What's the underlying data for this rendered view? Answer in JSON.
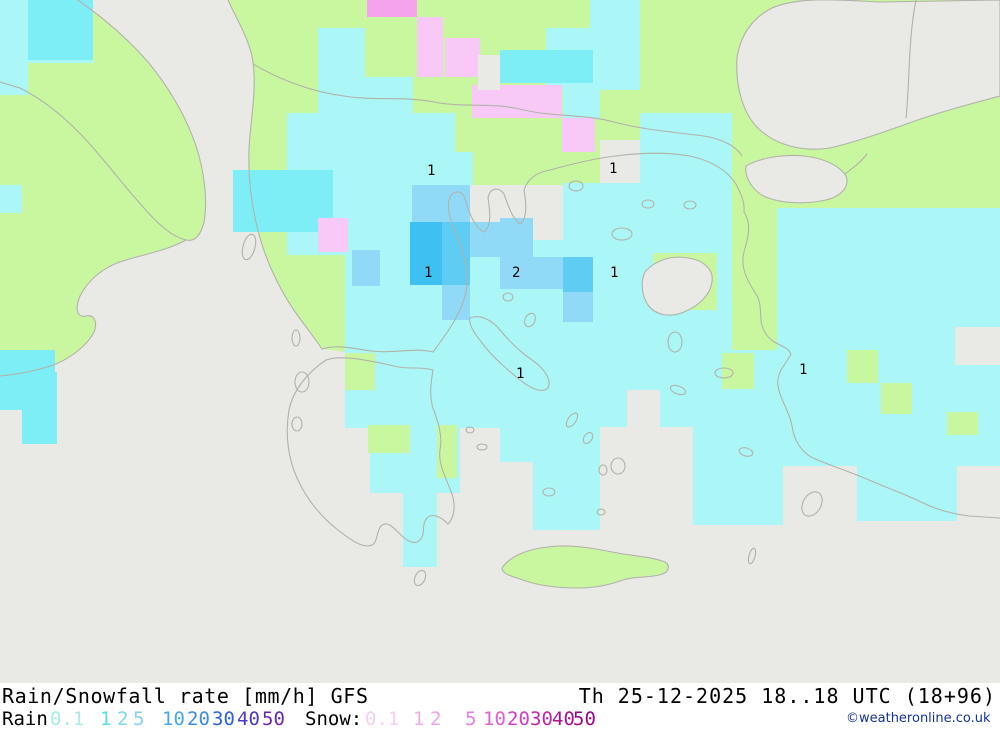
{
  "header": {
    "title_left": "Rain/Snowfall rate [mm/h] GFS",
    "title_right": "Th 25-12-2025 18..18 UTC (18+96)",
    "copyright": "©weatheronline.co.uk"
  },
  "legend": {
    "rain_label": "Rain",
    "rain_label_x": 2,
    "snow_label": "Snow:",
    "snow_label_x": 305,
    "rain_scale": [
      {
        "v": "0.1",
        "x": 50,
        "c": "#a9ebe7"
      },
      {
        "v": "1",
        "x": 100,
        "c": "#55dfe2"
      },
      {
        "v": "2",
        "x": 117,
        "c": "#7fd7f2"
      },
      {
        "v": "5",
        "x": 133,
        "c": "#86cef2"
      },
      {
        "v": "10",
        "x": 162,
        "c": "#47a8f0"
      },
      {
        "v": "20",
        "x": 187,
        "c": "#3b8bea"
      },
      {
        "v": "30",
        "x": 212,
        "c": "#2c63dd"
      },
      {
        "v": "40",
        "x": 237,
        "c": "#4a3ac9"
      },
      {
        "v": "50",
        "x": 262,
        "c": "#6b27b3"
      }
    ],
    "snow_scale": [
      {
        "v": "0.1",
        "x": 365,
        "c": "#f2d2ee"
      },
      {
        "v": "1",
        "x": 413,
        "c": "#efb0e9"
      },
      {
        "v": "2",
        "x": 430,
        "c": "#eda4e7"
      },
      {
        "v": "5",
        "x": 465,
        "c": "#e77edf"
      },
      {
        "v": "10",
        "x": 483,
        "c": "#e05fd3"
      },
      {
        "v": "20",
        "x": 507,
        "c": "#d33fc2"
      },
      {
        "v": "30",
        "x": 530,
        "c": "#c125aa"
      },
      {
        "v": "40",
        "x": 552,
        "c": "#aa1292"
      },
      {
        "v": "50",
        "x": 573,
        "c": "#9a0982"
      }
    ]
  },
  "map": {
    "width": 1000,
    "height": 683,
    "colors": {
      "sea": "#e9e9e6",
      "land": "#c9f7a0",
      "coast": "#b2b2aa",
      "pc": "#abf7f7",
      "cy": "#7deef6",
      "b2": "#90daf7",
      "b5": "#5fccf4",
      "b10": "#3fc0f2",
      "pk": "#f8c9f6",
      "mg": "#f6a3ee",
      "label": "#000000"
    },
    "land_paths": [
      "M78,0 C95,12 122,32 148,62 C168,86 186,116 196,146 C204,170 208,200 204,222 C201,234 196,242 186,240 C168,250 146,254 126,260 C104,266 88,280 80,296 C74,310 78,318 86,316 C94,314 98,322 94,332 C88,344 74,356 56,364 C40,370 20,374 0,376 L0,0 Z",
      "M228,0 C236,18 250,40 253,62 C257,92 250,122 249,150 C248,180 252,210 260,238 C268,266 282,294 298,316 C306,327 316,340 322,349 L345,352 L345,255 L412,255 L412,185 L563,185 L563,183 L600,183 L600,140 L640,140 L640,0 Z"
    ],
    "land_rects": [
      [
        640,
        0,
        360,
        148
      ],
      [
        732,
        148,
        268,
        62
      ],
      [
        815,
        205,
        185,
        165
      ],
      [
        732,
        205,
        45,
        148
      ]
    ],
    "sea_polys": [
      "M737,58 C740,36 752,18 772,8 C800,-4 840,0 880,2 L1000,0 L1000,96 C970,104 940,112 912,122 C884,132 856,142 830,148 C804,152 778,146 760,130 C744,116 735,88 737,58 Z",
      "M746,166 C760,158 782,154 804,156 C824,158 840,166 846,176 C850,186 842,196 826,200 C808,204 786,204 768,198 C754,193 744,178 746,166 Z"
    ],
    "cells": [
      [
        0,
        0,
        93,
        63,
        "pc"
      ],
      [
        0,
        63,
        28,
        32,
        "pc"
      ],
      [
        0,
        185,
        22,
        28,
        "pc"
      ],
      [
        318,
        28,
        47,
        87,
        "pc"
      ],
      [
        365,
        77,
        48,
        36,
        "pc"
      ],
      [
        546,
        28,
        94,
        62,
        "pc"
      ],
      [
        590,
        0,
        50,
        28,
        "pc"
      ],
      [
        563,
        90,
        37,
        28,
        "pc"
      ],
      [
        287,
        113,
        168,
        142,
        "pc"
      ],
      [
        445,
        152,
        28,
        33,
        "pc"
      ],
      [
        563,
        183,
        77,
        72,
        "pc"
      ],
      [
        345,
        240,
        295,
        120,
        "pc"
      ],
      [
        640,
        113,
        92,
        247,
        "pc"
      ],
      [
        777,
        208,
        223,
        157,
        "pc"
      ],
      [
        345,
        350,
        155,
        78,
        "pc"
      ],
      [
        370,
        428,
        90,
        65,
        "pc"
      ],
      [
        403,
        493,
        34,
        74,
        "pc"
      ],
      [
        500,
        350,
        127,
        77,
        "pc"
      ],
      [
        500,
        427,
        100,
        35,
        "pc"
      ],
      [
        533,
        462,
        33,
        68,
        "pc"
      ],
      [
        566,
        462,
        34,
        68,
        "pc"
      ],
      [
        627,
        350,
        66,
        40,
        "pc"
      ],
      [
        660,
        390,
        33,
        37,
        "pc"
      ],
      [
        693,
        350,
        307,
        78,
        "pc"
      ],
      [
        693,
        428,
        90,
        97,
        "pc"
      ],
      [
        783,
        428,
        217,
        38,
        "pc"
      ],
      [
        857,
        466,
        100,
        55,
        "pc"
      ],
      [
        28,
        0,
        65,
        60,
        "cy"
      ],
      [
        500,
        50,
        93,
        33,
        "cy"
      ],
      [
        233,
        170,
        100,
        62,
        "cy"
      ],
      [
        0,
        350,
        55,
        60,
        "cy"
      ],
      [
        22,
        372,
        35,
        72,
        "cy"
      ],
      [
        367,
        0,
        50,
        17,
        "mg"
      ],
      [
        417,
        17,
        26,
        60,
        "pk"
      ],
      [
        445,
        38,
        35,
        39,
        "pk"
      ],
      [
        472,
        85,
        90,
        33,
        "pk"
      ],
      [
        562,
        118,
        33,
        34,
        "pk"
      ],
      [
        318,
        218,
        30,
        34,
        "pk"
      ],
      [
        478,
        55,
        22,
        35,
        "sea"
      ],
      [
        470,
        190,
        93,
        50,
        "sea"
      ],
      [
        955,
        327,
        45,
        38,
        "sea"
      ],
      [
        412,
        185,
        58,
        37,
        "b2"
      ],
      [
        470,
        222,
        63,
        35,
        "b2"
      ],
      [
        500,
        218,
        33,
        39,
        "b2"
      ],
      [
        500,
        257,
        63,
        32,
        "b2"
      ],
      [
        352,
        250,
        28,
        36,
        "b2"
      ],
      [
        563,
        292,
        30,
        30,
        "b2"
      ],
      [
        442,
        285,
        28,
        35,
        "b2"
      ],
      [
        410,
        222,
        32,
        63,
        "b10"
      ],
      [
        442,
        222,
        28,
        63,
        "b5"
      ],
      [
        563,
        257,
        30,
        35,
        "b5"
      ],
      [
        653,
        253,
        64,
        57,
        "land"
      ],
      [
        722,
        353,
        32,
        36,
        "land"
      ],
      [
        847,
        350,
        31,
        33,
        "land"
      ],
      [
        881,
        383,
        31,
        31,
        "land"
      ],
      [
        947,
        412,
        31,
        23,
        "land"
      ],
      [
        345,
        353,
        30,
        37,
        "land"
      ],
      [
        368,
        425,
        42,
        28,
        "land"
      ],
      [
        437,
        425,
        20,
        53,
        "land"
      ]
    ],
    "island_fills": [
      "M645,272 C655,260 672,255 688,258 C704,260 714,270 712,282 C710,296 698,306 684,312 C670,318 655,315 648,305 C642,296 640,282 645,272 Z"
    ],
    "crete": "M502,568 C510,556 528,549 548,547 C570,544 592,548 612,552 C630,556 650,556 665,562 C671,566 669,573 659,575 C647,578 635,576 623,580 C609,585 595,588 579,588 C559,588 539,586 523,580 C511,576 502,574 502,568 Z",
    "coastlines": [
      "M78,0 C95,12 122,32 148,62 C168,86 186,116 196,146 C204,170 208,200 204,222 C201,234 196,242 186,240 C172,237 158,224 144,208 C124,186 106,162 88,142 C68,120 44,100 20,88 L0,82",
      "M186,240 C168,250 146,254 126,260 C104,266 88,280 80,296 C74,310 78,318 86,316 C94,314 98,322 94,332 C88,344 74,356 56,364 C40,370 20,374 0,376",
      "M228,0 C236,18 250,40 253,62 C257,92 250,122 249,150 C248,180 252,210 260,238 C268,266 282,294 298,316 C306,327 316,340 322,349",
      "M322,349 C338,344 355,349 372,351 C394,354 414,347 433,352",
      "M326,360 C308,372 293,390 289,410 C285,434 288,458 297,478 C306,498 320,516 338,530 C350,539 362,549 372,545 C378,542 376,532 381,526 C387,520 394,528 400,534 C406,540 414,546 420,540 C426,534 421,524 427,518 C433,512 442,518 448,524 C454,518 456,506 452,494 C446,478 438,464 440,450 C443,434 437,419 433,408 C429,396 431,382 433,370 C420,366 408,370 394,366 C376,362 344,354 326,360 Z",
      "M433,352 C448,332 462,312 466,292 C470,270 463,250 456,234 C450,220 446,206 450,197 C456,188 464,192 466,202 C470,216 476,228 484,232 C492,226 490,210 488,198 C490,188 498,186 504,194 C508,205 512,218 520,224 C528,218 526,202 524,190 C528,178 538,172 550,170 C568,165 588,160 608,157 C636,153 668,151 694,157 C714,162 728,172 736,184",
      "M736,184 C741,194 745,202 744,212",
      "M744,212 C752,224 748,238 744,252 C740,268 748,282 756,294 C764,306 757,322 766,334 C774,346 786,344 791,354 C785,366 776,372 778,386 C780,400 790,412 792,426 C794,440 801,452 813,458 C831,466 851,472 869,480 C887,488 905,494 921,502 C937,510 953,514 969,516 L1000,518",
      "M845,174 C853,168 861,162 867,154",
      "M253,64 C284,82 314,92 344,96 C374,101 404,96 434,102 C464,108 494,102 524,110 C554,117 584,114 614,122 C644,130 674,132 704,136 C722,139 736,146 742,156",
      "M916,0 C908,40 910,80 906,118",
      "M470,318 C480,314 492,320 500,330 C510,342 520,352 532,360 C544,368 552,380 548,388 C542,394 530,388 520,380 C508,370 496,360 486,348 C478,338 468,326 470,318 Z"
    ],
    "islands": [
      [
        249,
        247,
        6,
        13,
        15
      ],
      [
        296,
        338,
        4,
        8,
        0
      ],
      [
        302,
        382,
        7,
        10,
        0
      ],
      [
        297,
        424,
        5,
        7,
        0
      ],
      [
        420,
        578,
        5,
        8,
        25
      ],
      [
        622,
        234,
        10,
        6,
        0
      ],
      [
        576,
        186,
        7,
        5,
        0
      ],
      [
        648,
        204,
        6,
        4,
        0
      ],
      [
        675,
        342,
        7,
        10,
        0
      ],
      [
        724,
        373,
        9,
        5,
        0
      ],
      [
        678,
        390,
        8,
        4,
        20
      ],
      [
        572,
        420,
        4,
        8,
        35
      ],
      [
        588,
        438,
        4,
        6,
        35
      ],
      [
        618,
        466,
        7,
        8,
        0
      ],
      [
        603,
        470,
        4,
        5,
        0
      ],
      [
        549,
        492,
        6,
        4,
        0
      ],
      [
        601,
        512,
        4,
        3,
        0
      ],
      [
        746,
        452,
        7,
        4,
        15
      ],
      [
        812,
        504,
        9,
        13,
        30
      ],
      [
        752,
        556,
        3,
        8,
        15
      ],
      [
        530,
        320,
        5,
        7,
        25
      ],
      [
        508,
        297,
        5,
        4,
        0
      ],
      [
        470,
        430,
        4,
        3,
        0
      ],
      [
        482,
        447,
        5,
        3,
        0
      ],
      [
        690,
        205,
        6,
        4,
        0
      ]
    ],
    "value_labels": [
      [
        427,
        175,
        "1"
      ],
      [
        609,
        173,
        "1"
      ],
      [
        424,
        277,
        "1"
      ],
      [
        610,
        277,
        "1"
      ],
      [
        512,
        277,
        "2"
      ],
      [
        516,
        378,
        "1"
      ],
      [
        799,
        374,
        "1"
      ]
    ]
  }
}
